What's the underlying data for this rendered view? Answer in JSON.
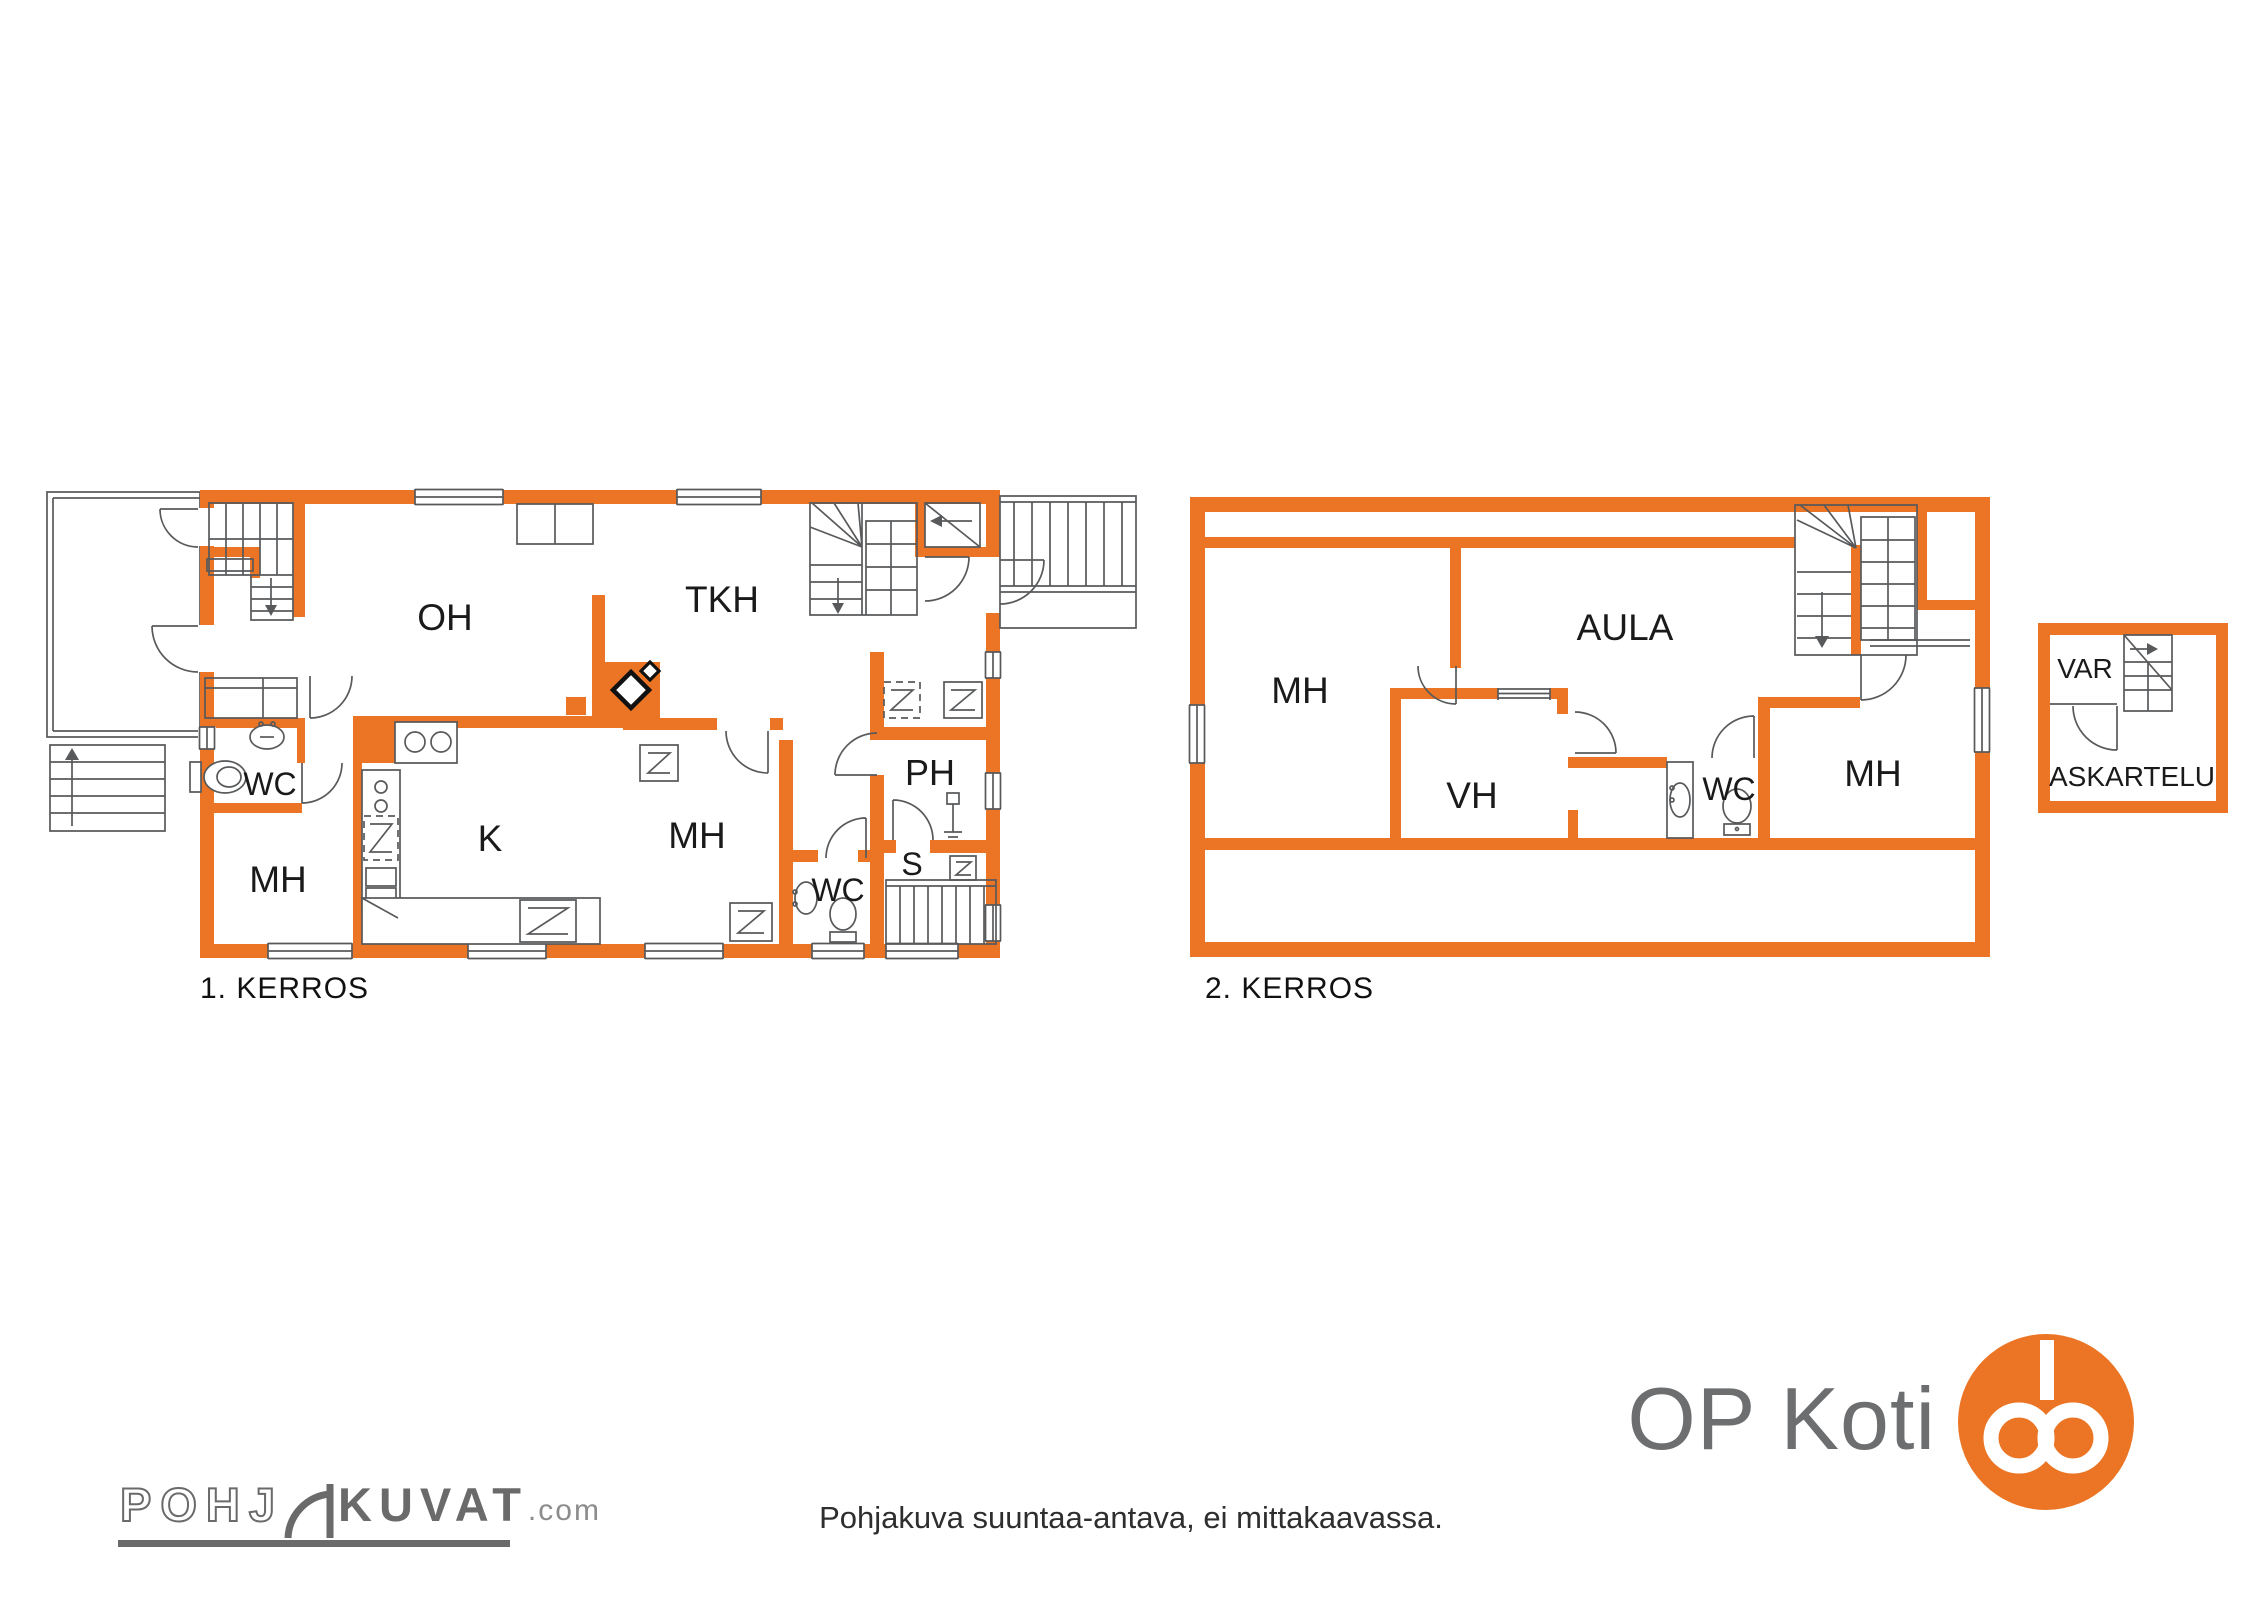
{
  "colors": {
    "accent": "#EB7524",
    "line": "#58595B",
    "brand_gray": "#6d6e70"
  },
  "floor1": {
    "caption": "1. KERROS",
    "rooms": [
      {
        "label": "OH"
      },
      {
        "label": "TKH"
      },
      {
        "label": "WC"
      },
      {
        "label": "MH"
      },
      {
        "label": "K"
      },
      {
        "label": "MH"
      },
      {
        "label": "WC"
      },
      {
        "label": "PH"
      },
      {
        "label": "S"
      }
    ]
  },
  "floor2": {
    "caption": "2. KERROS",
    "rooms": [
      {
        "label": "MH"
      },
      {
        "label": "AULA"
      },
      {
        "label": "VH"
      },
      {
        "label": "WC"
      },
      {
        "label": "MH"
      }
    ]
  },
  "outbuilding": {
    "rooms": [
      {
        "label": "VAR"
      },
      {
        "label": "ASKARTELU"
      }
    ]
  },
  "footer": {
    "note": "Pohjakuva suuntaa-antava, ei mittakaavassa.",
    "brand_left": {
      "part1": "POHJ",
      "part2": "KUVAT",
      "part3": ".com"
    },
    "brand_right": {
      "name": "OP Koti"
    }
  }
}
